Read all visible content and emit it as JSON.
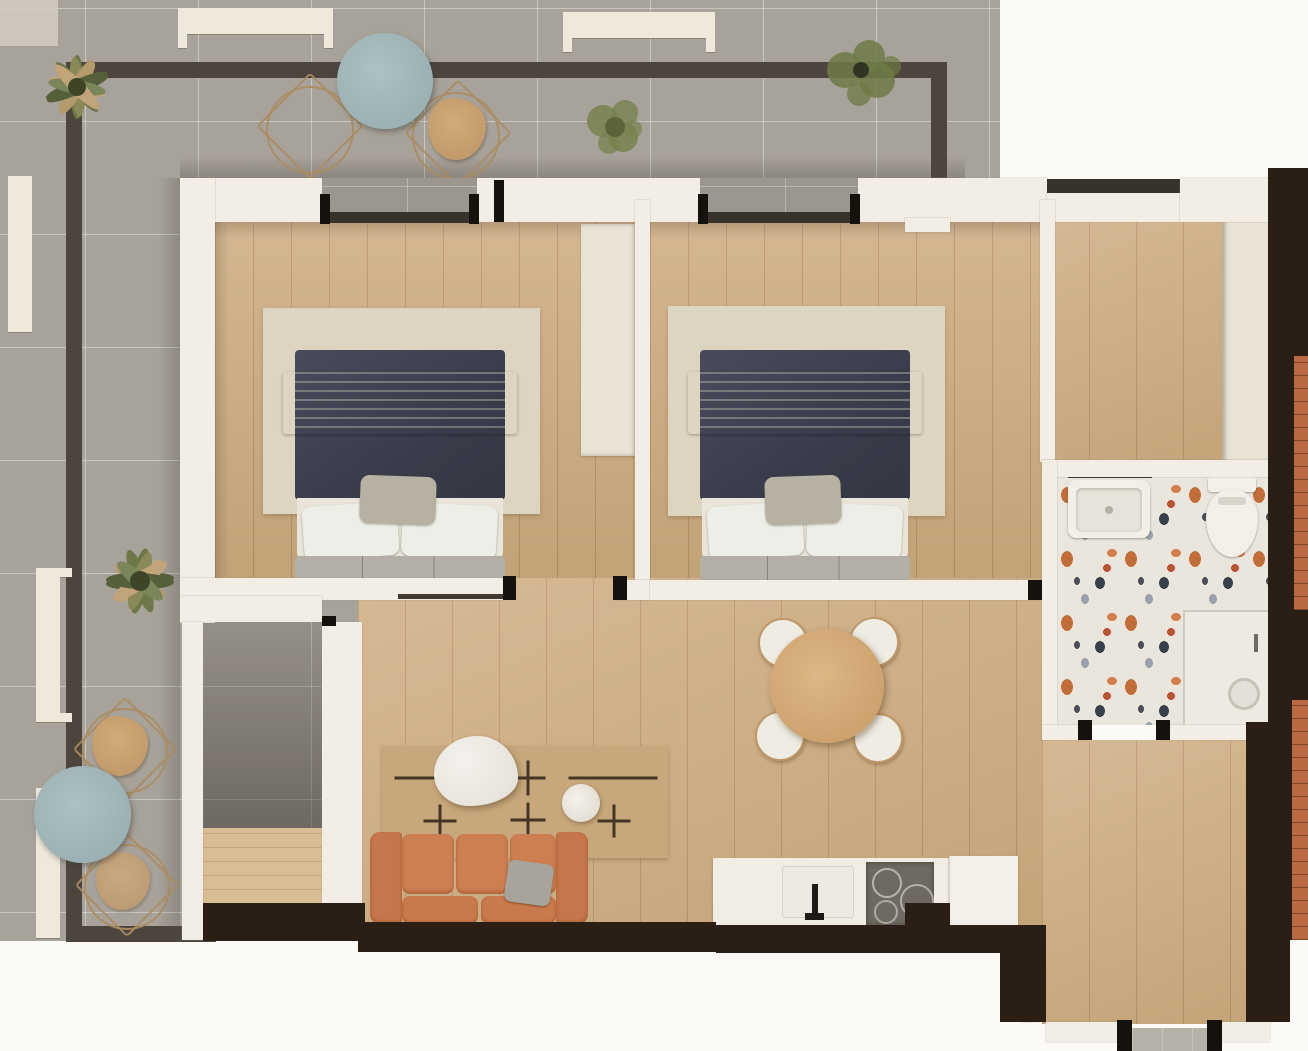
{
  "meta": {
    "kind": "apartment floor plan - top-down architectural render",
    "view": "top-down"
  },
  "palette": {
    "outside": "#fbfaf7",
    "tile": "#a8a39a",
    "wood": "#d0af84",
    "wall": "#f3eee5",
    "dark": "#2a1e15",
    "cream": "#efe9dc",
    "railing": "#4b453e",
    "terrazzo": "#eae6de",
    "rugbed": "#ddd5c2",
    "rugliving": "#c7a77b",
    "sofa": "#c5764a",
    "navy": "#3f4351",
    "tableblue": "#a3b7ba",
    "woodtable": "#d0a671",
    "wardrobe": "#e9e3d5",
    "brick": "#b96a43"
  },
  "rooms": [
    {
      "id": "terrace",
      "floor": "grey ceramic tile",
      "furniture": [
        "round-bistro-table-north",
        "round-bistro-table-south",
        "wire-frame-chairs",
        "potted-plants-x4",
        "perimeter-railing"
      ]
    },
    {
      "id": "bedroom-1",
      "floor": "wood plank",
      "furniture": [
        "double-bed-navy-duvet",
        "grey-throw",
        "pillows",
        "foot-bench",
        "area-rug",
        "wardrobe-cabinet"
      ]
    },
    {
      "id": "bedroom-2",
      "floor": "wood plank",
      "furniture": [
        "double-bed-navy-duvet",
        "grey-throw",
        "pillows",
        "foot-bench",
        "area-rug"
      ]
    },
    {
      "id": "living-dining",
      "floor": "wood plank",
      "furniture": [
        "terracotta-sofa",
        "grey-toss-pillow",
        "patterned-rug",
        "marble-coffee-table",
        "side-pouf",
        "round-dining-table",
        "dining-chairs-x4"
      ]
    },
    {
      "id": "kitchen",
      "floor": "wood plank",
      "furniture": [
        "counter-run",
        "sink-with-faucet",
        "cooktop",
        "refrigerator"
      ]
    },
    {
      "id": "bathroom",
      "floor": "terrazzo",
      "furniture": [
        "vanity-sink",
        "toilet",
        "walk-in-shower-with-drain"
      ]
    },
    {
      "id": "wardrobe-hall",
      "floor": "wood plank",
      "furniture": [
        "built-in-closet-strip"
      ]
    },
    {
      "id": "entry-hall",
      "floor": "wood plank",
      "furniture": [
        "entry-door-threshold"
      ]
    }
  ]
}
